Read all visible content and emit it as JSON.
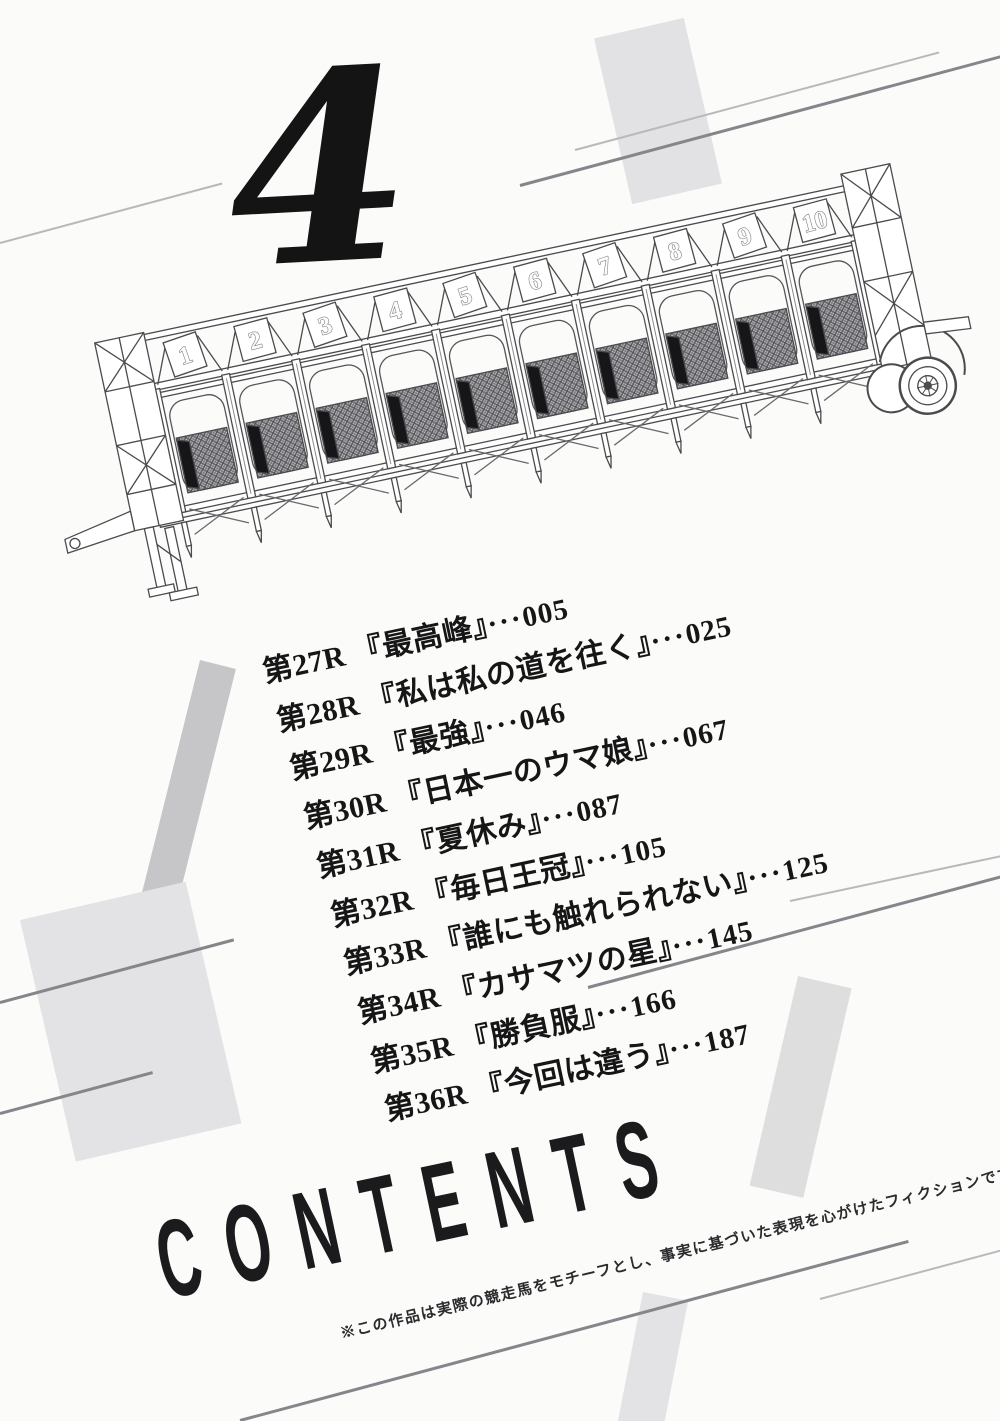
{
  "page": {
    "volume_number": "4",
    "contents_title": "CONTENTS",
    "disclaimer": "※この作品は実際の競走馬をモチーフとし、事実に基づいた表現を心がけたフィクションです。"
  },
  "toc": {
    "separator": "···",
    "entries": [
      {
        "race": "第27R",
        "title": "『最高峰』",
        "page": "005"
      },
      {
        "race": "第28R",
        "title": "『私は私の道を往く』",
        "page": "025"
      },
      {
        "race": "第29R",
        "title": "『最強』",
        "page": "046"
      },
      {
        "race": "第30R",
        "title": "『日本一のウマ娘』",
        "page": "067"
      },
      {
        "race": "第31R",
        "title": "『夏休み』",
        "page": "087"
      },
      {
        "race": "第32R",
        "title": "『毎日王冠』",
        "page": "105"
      },
      {
        "race": "第33R",
        "title": "『誰にも触れられない』",
        "page": "125"
      },
      {
        "race": "第34R",
        "title": "『カサマツの星』",
        "page": "145"
      },
      {
        "race": "第35R",
        "title": "『勝負服』",
        "page": "166"
      },
      {
        "race": "第36R",
        "title": "『今回は違う』",
        "page": "187"
      }
    ]
  },
  "gate": {
    "stall_numbers": [
      "1",
      "2",
      "3",
      "4",
      "5",
      "6",
      "7",
      "8",
      "9",
      "10"
    ]
  },
  "colors": {
    "ink": "#1a1a1a",
    "light_gray": "#e3e3e5",
    "mid_gray": "#c6c6c8",
    "line_dark": "#85858a",
    "line_light": "#b9b9bc",
    "gate_stroke": "#4b4b4e"
  }
}
